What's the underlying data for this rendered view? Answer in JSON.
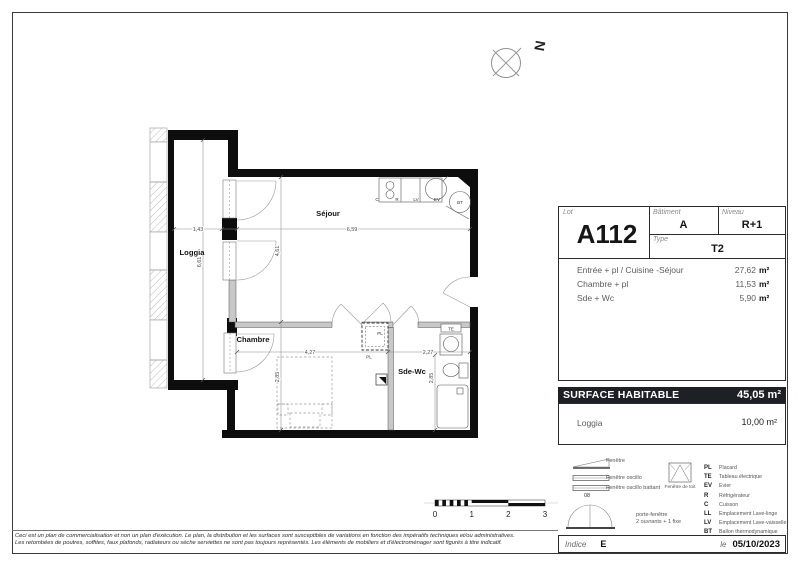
{
  "title_block": {
    "lot_label": "Lot",
    "lot_value": "A112",
    "batiment_label": "Bâtiment",
    "batiment_value": "A",
    "niveau_label": "Niveau",
    "niveau_value": "R+1",
    "type_label": "Type",
    "type_value": "T2",
    "areas": [
      {
        "label": "Entrée + pl / Cuisine -Séjour",
        "value": "27,62",
        "unit": "m²"
      },
      {
        "label": "Chambre + pl",
        "value": "11,53",
        "unit": "m²"
      },
      {
        "label": "Sde + Wc",
        "value": "5,90",
        "unit": "m²"
      }
    ],
    "surface_label": "SURFACE HABITABLE",
    "surface_value": "45,05 m²",
    "loggia_label": "Loggia",
    "loggia_value": "10,00 m²",
    "indice_label": "Indice",
    "indice_value": "E",
    "date_prefix": "le",
    "date_value": "05/10/2023"
  },
  "legend": {
    "fenetre": "Fenêtre",
    "fenetre_oscillo": "Fenêtre oscillo",
    "fenetre_oscillo_battant": "Fenêtre oscillo battant",
    "oscillo_code": "08",
    "fenetre_de_toit": "Fenêtre de toit",
    "porte_fenetre": "porte-fenêtre",
    "porte_fenetre_detail": "2 ouvrants + 1 fixe",
    "abbreviations": [
      {
        "code": "PL",
        "label": "Placard"
      },
      {
        "code": "TE",
        "label": "Tableau électrique"
      },
      {
        "code": "EV",
        "label": "Evier"
      },
      {
        "code": "R",
        "label": "Réfrigérateur"
      },
      {
        "code": "C",
        "label": "Cuisson"
      },
      {
        "code": "LL",
        "label": "Emplacement Lave-linge"
      },
      {
        "code": "LV",
        "label": "Emplacement Lave-vaisselle"
      },
      {
        "code": "BT",
        "label": "Ballon thermodynamique"
      }
    ]
  },
  "plan": {
    "compass_label": "N",
    "rooms": {
      "loggia": "Loggia",
      "sejour": "Séjour",
      "chambre": "Chambre",
      "sdewc": "Sde-Wc"
    },
    "dims": {
      "loggia_w": "1,43",
      "loggia_h": "6,61",
      "sejour_w": "6,59",
      "sejour_h": "4,61",
      "chambre_w": "4,27",
      "chambre_h": "2,85",
      "sdewc_w": "2,27",
      "sdewc_h": "2,85"
    },
    "tags": {
      "c": "C",
      "r": "R",
      "lv": "LV",
      "ev": "EV",
      "bt": "BT",
      "te": "TE",
      "pl_closet": "PL",
      "pl_chambre": "PL"
    },
    "scale_ticks": [
      "0",
      "1",
      "2",
      "3"
    ]
  },
  "footer": {
    "disclaimer_line1": "Ceci est un plan de commercialisation et non un plan d'exécution. Le plan, la distribution et les surfaces sont susceptibles de variations en fonction des impératifs techniques et/ou administratives.",
    "disclaimer_line2": "Les retombées de poutres, soffites, faux plafonds, radiateurs ou sèche serviettes ne sont pas toujours représentés. Les éléments de mobiliers et d'électroménager sont figurés à titre indicatif."
  },
  "colors": {
    "wall": "#0d0d0d",
    "partition": "#c8c8c8",
    "surface_bar_bg": "#1d2126",
    "surface_bar_text": "#ffffff",
    "dim_line": "#888888"
  }
}
